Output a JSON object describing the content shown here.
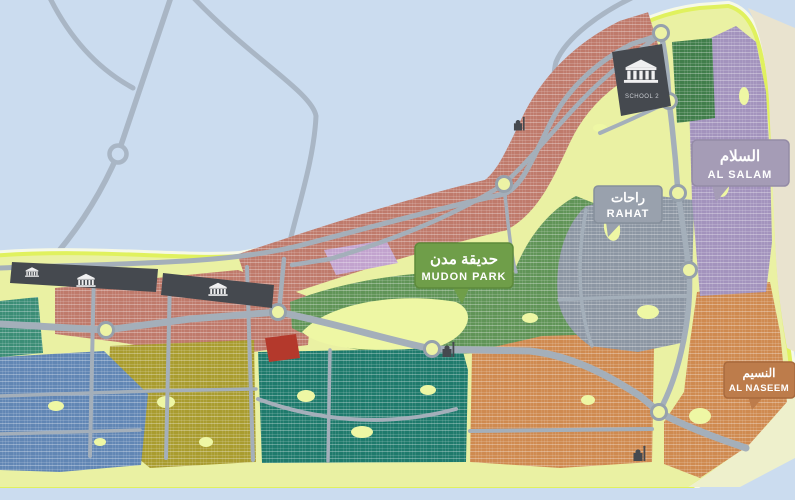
{
  "map": {
    "title": "Mudon community master plan map",
    "colors": {
      "water": "#cbdcef",
      "waterRoad": "#a9b6c5",
      "land": "#eaf1a3",
      "landEdge": "#e0f15e",
      "waterline": "#f6f9e7",
      "road": "#a4afba",
      "sand": "#e9e3cf",
      "beach": "#eef0cc",
      "salmon": "#bf7a6b",
      "purpleBlock": "#c2a3ce",
      "green": "#609457",
      "greenDark": "#417e4b",
      "teal": "#1e7a6c",
      "tealLeft": "#3b8d76",
      "olive": "#a99c2f",
      "blue": "#6186b4",
      "orange": "#cf8a50",
      "slate": "#8c96a3",
      "purple": "#a393bd",
      "charcoal": "#45494f",
      "red": "#b4392c",
      "park": "#eef7a4"
    },
    "signs": {
      "mudon_park": {
        "arabic": "حديقة مدن",
        "latin": "MUDON PARK",
        "bg": "#6f9e49",
        "border": "#5d8a3b"
      },
      "rahat": {
        "arabic": "راحات",
        "latin": "RAHAT",
        "bg": "#99a1ad",
        "border": "#868f9b"
      },
      "al_salam": {
        "arabic": "السلام",
        "latin": "AL SALAM",
        "bg": "#a59cb6",
        "border": "#948ba6"
      },
      "al_naseem": {
        "arabic": "النسيم",
        "latin": "AL NASEEM",
        "bg": "#bd7c4b",
        "border": "#a8693c"
      }
    },
    "landmarks": {
      "school": {
        "label": "SCHOOL 2",
        "icon": "building-icon"
      }
    }
  }
}
